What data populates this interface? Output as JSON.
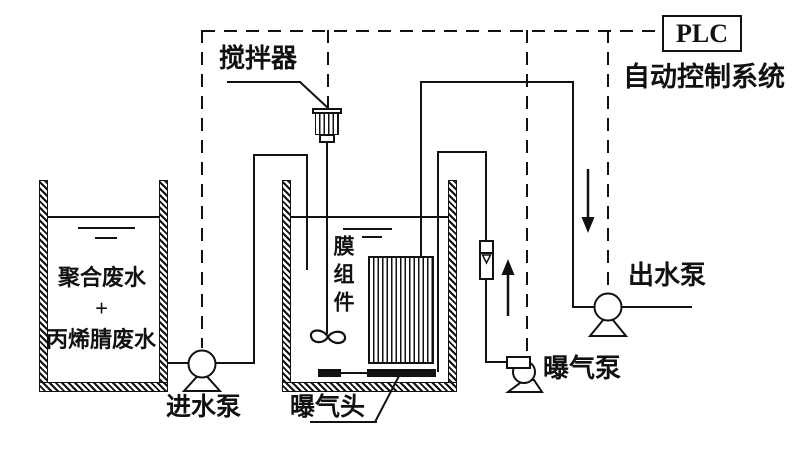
{
  "labels": {
    "plc": "PLC",
    "control_system": "自动控制系统",
    "stirrer": "搅拌器",
    "membrane_module": "膜组件",
    "feed_tank": {
      "line1": "聚合废水",
      "plus": "+",
      "line2": "丙烯腈废水"
    },
    "feed_pump": "进水泵",
    "aeration_head": "曝气头",
    "aeration_pump": "曝气泵",
    "effluent_pump": "出水泵"
  },
  "icons": {
    "feed_pump": "pump-circle-with-pedestal",
    "effluent_pump": "pump-circle-with-pedestal",
    "aeration_pump": "blower-scroll-with-pedestal",
    "stirrer_motor": "ribbed-motor",
    "stirrer_impeller": "propeller-loops",
    "flow_meter": "rotameter-with-float",
    "air_flow_arrow": "arrow-up",
    "control_flow_arrow": "arrow-down"
  },
  "colors": {
    "line": "#111111",
    "background": "#ffffff"
  }
}
